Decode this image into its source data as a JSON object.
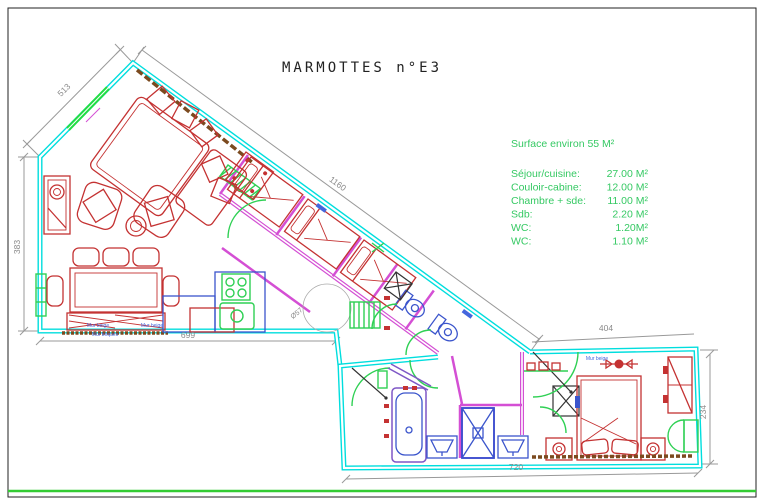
{
  "title": "MARMOTTES n°E3",
  "surface_summary": {
    "header": "Surface environ 55 M²",
    "rooms": [
      {
        "label": "Séjour/cuisine:",
        "value": "27.00 M²"
      },
      {
        "label": "Couloir-cabine:",
        "value": "12.00 M²"
      },
      {
        "label": "Chambre + sde:",
        "value": "11.00 M²"
      },
      {
        "label": "Sdb:",
        "value": "2.20 M²"
      },
      {
        "label": "WC:",
        "value": "1.20M²"
      },
      {
        "label": "WC:",
        "value": "1.10 M²"
      }
    ]
  },
  "dimensions": {
    "top_left_wall": "513",
    "main_diagonal": "1160",
    "left_wall": "383",
    "sejour_bottom": "699",
    "chambre_top": "404",
    "chambre_bottom": "720",
    "chambre_right": "234",
    "kitchen_table_diameter": "Ø57"
  },
  "wall_labels": {
    "mur_beige_1": "Mur beige",
    "mur_briques": "Mur briques",
    "mur_beige_2": "Mur beige",
    "mur_beige_3": "Mur beige"
  },
  "colors": {
    "walls_cyan": "#00dede",
    "partitions_magenta": "#d44fd4",
    "furniture_red": "#c43232",
    "fixtures_blue": "#3b55cc",
    "doors_windows_green": "#2fd054",
    "annotation_green": "#35c963",
    "dimension_gray": "#8a8a8a",
    "hatch_brown": "#7b4a1f",
    "label_blue": "#4466dd",
    "page_border": "#222222",
    "bottom_rule_green": "#33cc33"
  }
}
